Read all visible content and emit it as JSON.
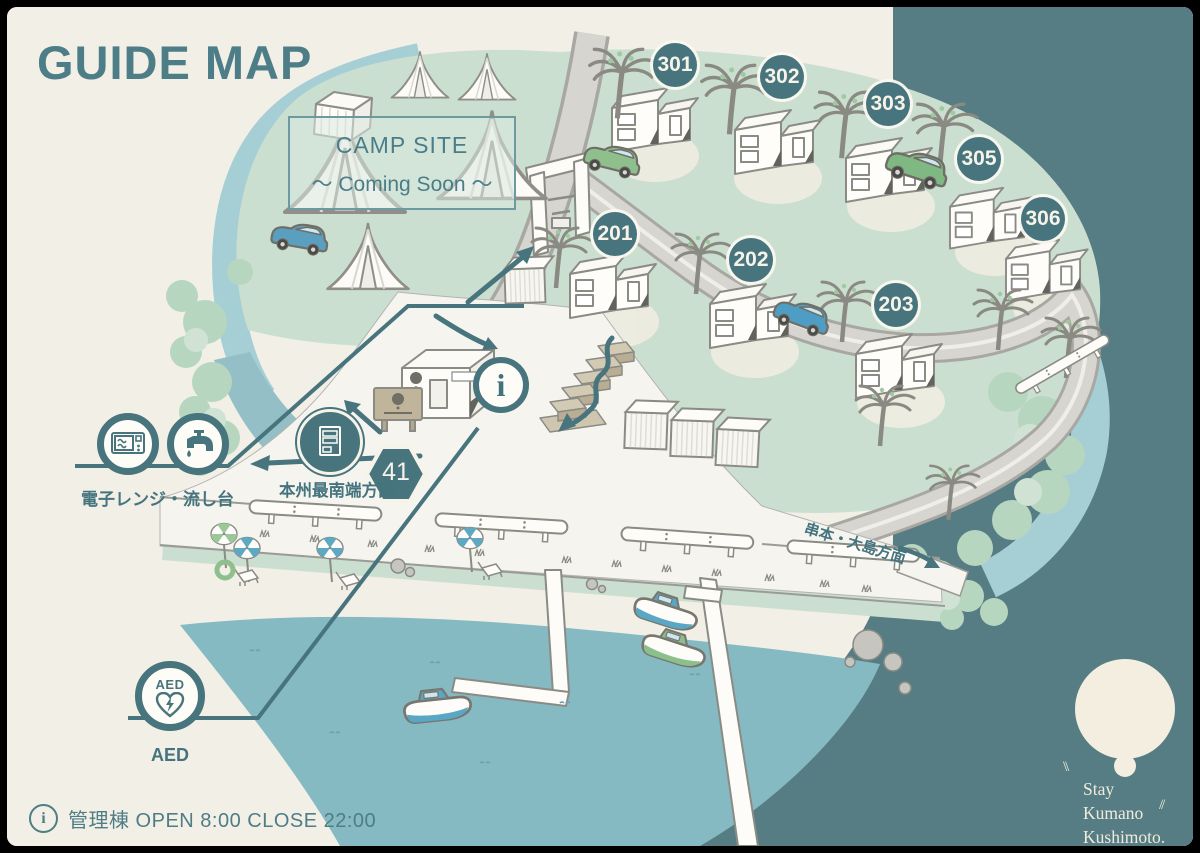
{
  "title": "GUIDE MAP",
  "camp_site": {
    "title": "CAMP SITE",
    "subtitle": "～ Coming Soon ～"
  },
  "markers": [
    {
      "label": "301"
    },
    {
      "label": "302"
    },
    {
      "label": "303"
    },
    {
      "label": "305"
    },
    {
      "label": "306"
    },
    {
      "label": "201"
    },
    {
      "label": "202"
    },
    {
      "label": "203"
    }
  ],
  "signs": {
    "route_number": "41",
    "direction_left": "本州最南端方面",
    "direction_right": "串本・大島方面"
  },
  "facilities": {
    "microwave_sink": {
      "label": "電子レンジ・流し台",
      "icons": [
        "microwave-icon",
        "faucet-icon"
      ]
    },
    "vending": {
      "icon": "vending-machine-icon"
    },
    "aed": {
      "label": "AED",
      "icon_text": "AED",
      "icon": "aed-heart-icon"
    },
    "info": {
      "glyph": "i",
      "icon": "information-icon"
    }
  },
  "footer": {
    "info_glyph": "i",
    "text": "管理棟 OPEN 8:00 CLOSE 22:00"
  },
  "logo": {
    "mark_left": "\\\\",
    "mark_right": "//",
    "lines": [
      "Stay",
      "Kumano",
      "Kushimoto."
    ]
  },
  "colors": {
    "background_cream": "#f2efe6",
    "sea_dark": "#557d83",
    "teal_primary": "#47747d",
    "lawn_green": "#cbdfd0",
    "harbor_water": "#85bac3",
    "river": "#a5ced5"
  }
}
